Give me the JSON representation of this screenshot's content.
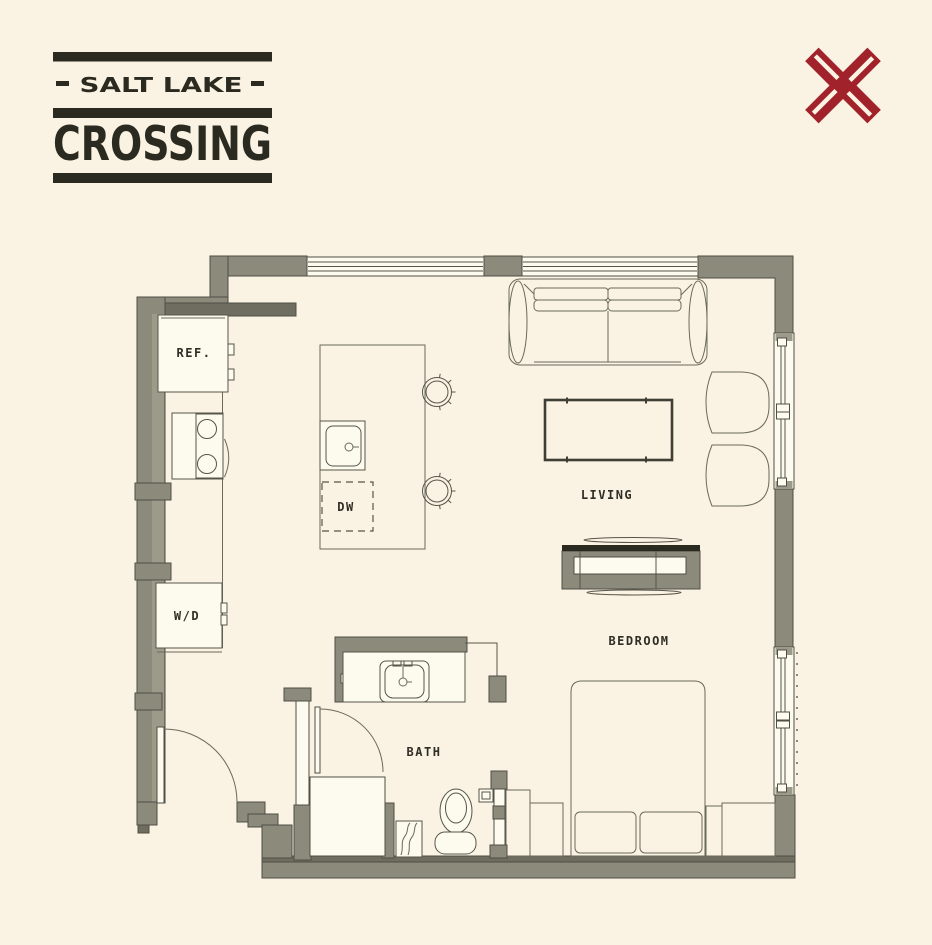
{
  "brand": {
    "name_top": "SALT LAKE",
    "name_bottom": "CROSSING"
  },
  "floor_plan": {
    "rooms": {
      "living": "LIVING",
      "bedroom": "BEDROOM",
      "bath": "BATH"
    },
    "fixtures": {
      "refrigerator": "REF.",
      "dishwasher": "DW",
      "washer_dryer": "W/D"
    }
  },
  "colors": {
    "background": "#FAF2E2",
    "wall": "#8B8A7B",
    "wall_shadow": "#6E6D5F",
    "outline": "#504F45",
    "ink": "#2B2A20",
    "accent_red": "#A1222A",
    "fixture_white": "#FDFBEF"
  }
}
